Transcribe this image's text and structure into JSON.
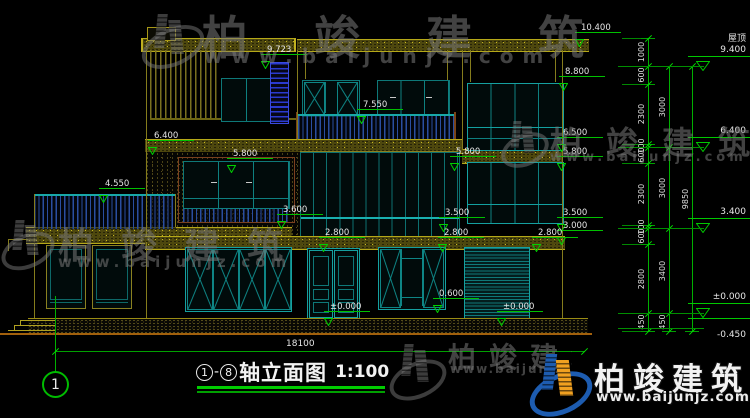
{
  "watermark": {
    "brand": "柏竣建筑",
    "url": "www.baijunjz.com"
  },
  "title": {
    "bubble_left": "1",
    "dash": "-",
    "bubble_right": "8",
    "name": "轴立面图",
    "scale": "1:100"
  },
  "axis_bubble": "1",
  "bottom_dim": "18100",
  "right_elevations": [
    {
      "label": "屋顶",
      "value": "9.400",
      "y": 66,
      "tri": true,
      "below": false
    },
    {
      "label": "",
      "value": "6.400",
      "y": 147,
      "tri": true,
      "below": false
    },
    {
      "label": "",
      "value": "3.400",
      "y": 228,
      "tri": true,
      "below": false
    },
    {
      "label": "",
      "value": "±0.000",
      "y": 313,
      "tri": true,
      "below": false
    },
    {
      "label": "",
      "value": "-0.450",
      "y": 328,
      "tri": false,
      "below": true
    }
  ],
  "markers": [
    {
      "label": "9.723",
      "x": 263,
      "y": 62
    },
    {
      "label": "10.400",
      "x": 577,
      "y": 40
    },
    {
      "label": "8.800",
      "x": 561,
      "y": 84
    },
    {
      "label": "7.550",
      "x": 359,
      "y": 117
    },
    {
      "label": "6.400",
      "x": 150,
      "y": 148
    },
    {
      "label": "5.800",
      "x": 229,
      "y": 166
    },
    {
      "label": "5.800",
      "x": 452,
      "y": 164
    },
    {
      "label": "6.500",
      "x": 559,
      "y": 145
    },
    {
      "label": "5.800",
      "x": 559,
      "y": 164
    },
    {
      "label": "4.550",
      "x": 101,
      "y": 196
    },
    {
      "label": "3.600",
      "x": 279,
      "y": 222
    },
    {
      "label": "3.500",
      "x": 441,
      "y": 225
    },
    {
      "label": "3.500",
      "x": 559,
      "y": 225
    },
    {
      "label": "3.000",
      "x": 559,
      "y": 238
    },
    {
      "label": "2.800",
      "x": 321,
      "y": 245
    },
    {
      "label": "2.800",
      "x": 440,
      "y": 245
    },
    {
      "label": "2.800",
      "x": 534,
      "y": 245
    },
    {
      "label": "0.600",
      "x": 435,
      "y": 306
    },
    {
      "label": "±0.000",
      "x": 326,
      "y": 319
    },
    {
      "label": "±0.000",
      "x": 499,
      "y": 319
    }
  ],
  "dim_chains": [
    {
      "x": 648,
      "bounds": [
        38,
        66,
        84,
        144,
        147,
        163,
        225,
        228,
        244,
        313,
        331
      ],
      "labels": [
        "1000",
        "600",
        "2300",
        "100",
        "600",
        "2300",
        "100",
        "600",
        "2800",
        "450"
      ]
    },
    {
      "x": 669,
      "bounds": [
        66,
        147,
        228,
        313,
        331
      ],
      "labels": [
        "3000",
        "3000",
        "3400",
        "450"
      ]
    },
    {
      "x": 692,
      "bounds": [
        66,
        331
      ],
      "labels": [
        "9850"
      ]
    }
  ],
  "connector_ys": [
    66,
    147,
    228,
    313,
    328
  ]
}
